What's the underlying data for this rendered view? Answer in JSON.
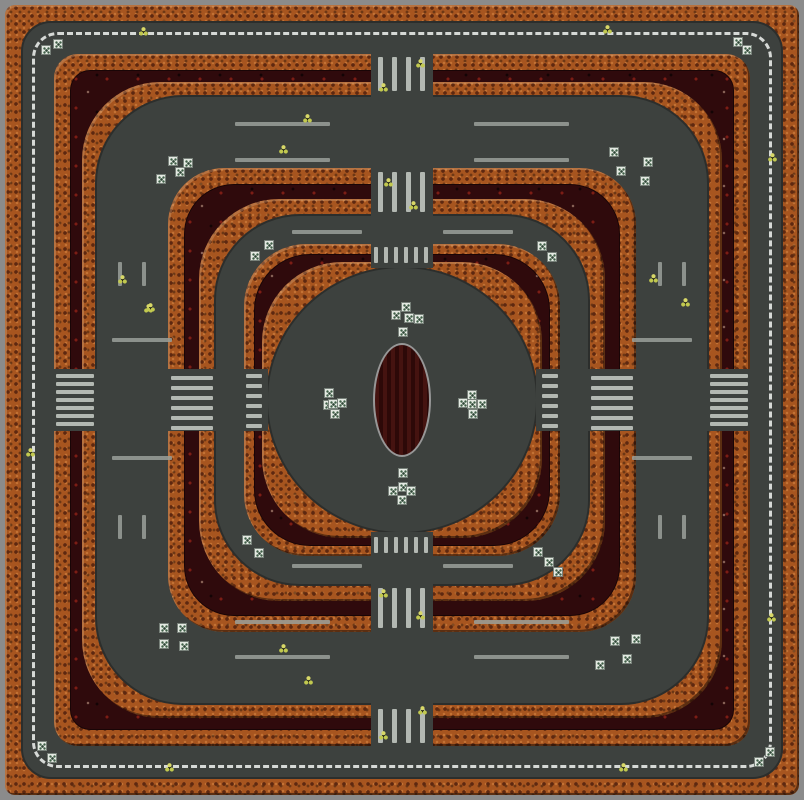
{
  "map": {
    "width": 804,
    "height": 800,
    "colors": {
      "frame": "#8b8b8b",
      "road": "#3d413e",
      "brick": "#a7551f",
      "brickDot": "#5e2810",
      "maroon": "#2f0a0c",
      "maroonDot": "#7c1d15",
      "bar": "#b3b8b2",
      "stripe": "#9aa09a",
      "dash": "#d6d9d6",
      "boxFill": "#e4e9e2",
      "boxDot": "#3e5e46",
      "spark": "#d8d867",
      "spark2": "#c2c94f",
      "ovalFill": "#451310",
      "ovalBorder": "#979797"
    },
    "rings": [
      {
        "name": "outer-frame",
        "inset": 0,
        "radius": 0,
        "fill": "frame"
      },
      {
        "name": "outer-brick-wall",
        "inset": 5,
        "radius": 10,
        "fill": "brick"
      },
      {
        "name": "outer-road",
        "inset": 21,
        "radius": 30,
        "fill": "road"
      },
      {
        "name": "wall-c-outer-brick",
        "inset": 54,
        "radius": 24,
        "fill": "brick"
      },
      {
        "name": "wall-c-moat",
        "inset": 70,
        "radius": 20,
        "fill": "maroon"
      },
      {
        "name": "wall-c-inner-brick",
        "inset": 82,
        "radius": 78,
        "fill": "brick"
      },
      {
        "name": "road-ring-2",
        "inset": 95,
        "radius": 88,
        "fill": "road"
      },
      {
        "name": "wall-b-outer-brick",
        "inset": 168,
        "radius": 56,
        "fill": "brick"
      },
      {
        "name": "wall-b-moat",
        "inset": 184,
        "radius": 50,
        "fill": "maroon"
      },
      {
        "name": "wall-b-inner-brick",
        "inset": 199,
        "radius": 80,
        "fill": "brick"
      },
      {
        "name": "road-ring-3",
        "inset": 214,
        "radius": 86,
        "fill": "road"
      },
      {
        "name": "wall-a-outer-brick",
        "inset": 244,
        "radius": 62,
        "fill": "brick"
      },
      {
        "name": "wall-a-moat",
        "inset": 254,
        "radius": 56,
        "fill": "maroon"
      },
      {
        "name": "wall-a-inner-brick",
        "inset": 262,
        "radius": 80,
        "fill": "brick"
      },
      {
        "name": "center-plaza",
        "inset": 266,
        "radius": "50%",
        "fill": "road"
      }
    ],
    "center_dash_ring": {
      "inset": 32,
      "radius": 26
    },
    "oval": {
      "cx": 402,
      "cy": 400,
      "w": 58,
      "h": 114
    },
    "crossings": [
      {
        "name": "north-outer",
        "cut": [
          371,
          52,
          62,
          45
        ],
        "bars": {
          "o": "v",
          "x": 378,
          "y": 57,
          "step": 14,
          "count": 4,
          "len": 34,
          "th": 5
        }
      },
      {
        "name": "north-mid",
        "cut": [
          371,
          167,
          62,
          49
        ],
        "bars": {
          "o": "v",
          "x": 378,
          "y": 172,
          "step": 14,
          "count": 4,
          "len": 40,
          "th": 5
        }
      },
      {
        "name": "north-inner",
        "cut": [
          371,
          243,
          62,
          25
        ],
        "bars": {
          "o": "v",
          "x": 374,
          "y": 247,
          "step": 10,
          "count": 6,
          "len": 16,
          "th": 4
        }
      },
      {
        "name": "south-inner",
        "cut": [
          371,
          532,
          62,
          25
        ],
        "bars": {
          "o": "v",
          "x": 374,
          "y": 537,
          "step": 10,
          "count": 6,
          "len": 16,
          "th": 4
        }
      },
      {
        "name": "south-mid",
        "cut": [
          371,
          584,
          62,
          49
        ],
        "bars": {
          "o": "v",
          "x": 378,
          "y": 588,
          "step": 14,
          "count": 4,
          "len": 40,
          "th": 5
        }
      },
      {
        "name": "south-outer",
        "cut": [
          371,
          703,
          62,
          45
        ],
        "bars": {
          "o": "v",
          "x": 378,
          "y": 709,
          "step": 14,
          "count": 4,
          "len": 34,
          "th": 5
        }
      },
      {
        "name": "west-outer",
        "cut": [
          52,
          369,
          45,
          62
        ],
        "bars": {
          "o": "h",
          "x": 56,
          "y": 374,
          "step": 8,
          "count": 7,
          "len": 38,
          "th": 4
        }
      },
      {
        "name": "west-mid",
        "cut": [
          167,
          369,
          49,
          62
        ],
        "bars": {
          "o": "h",
          "x": 171,
          "y": 376,
          "step": 10,
          "count": 6,
          "len": 42,
          "th": 4
        }
      },
      {
        "name": "west-inner",
        "cut": [
          243,
          369,
          25,
          62
        ],
        "bars": {
          "o": "h",
          "x": 246,
          "y": 374,
          "step": 10,
          "count": 6,
          "len": 16,
          "th": 4
        }
      },
      {
        "name": "east-inner",
        "cut": [
          536,
          369,
          25,
          62
        ],
        "bars": {
          "o": "h",
          "x": 542,
          "y": 374,
          "step": 10,
          "count": 6,
          "len": 16,
          "th": 4
        }
      },
      {
        "name": "east-mid",
        "cut": [
          588,
          369,
          49,
          62
        ],
        "bars": {
          "o": "h",
          "x": 591,
          "y": 376,
          "step": 10,
          "count": 6,
          "len": 42,
          "th": 4
        }
      },
      {
        "name": "east-outer",
        "cut": [
          707,
          369,
          45,
          62
        ],
        "bars": {
          "o": "h",
          "x": 710,
          "y": 374,
          "step": 8,
          "count": 7,
          "len": 38,
          "th": 4
        }
      }
    ],
    "lane_stripes": [
      [
        292,
        230,
        70,
        4
      ],
      [
        443,
        230,
        70,
        4
      ],
      [
        292,
        564,
        70,
        4
      ],
      [
        443,
        564,
        70,
        4
      ],
      [
        112,
        338,
        60,
        4
      ],
      [
        112,
        456,
        60,
        4
      ],
      [
        632,
        338,
        60,
        4
      ],
      [
        632,
        456,
        60,
        4
      ],
      [
        235,
        620,
        95,
        4
      ],
      [
        474,
        620,
        95,
        4
      ],
      [
        235,
        655,
        95,
        4
      ],
      [
        474,
        655,
        95,
        4
      ],
      [
        235,
        122,
        95,
        4
      ],
      [
        474,
        122,
        95,
        4
      ],
      [
        235,
        158,
        95,
        4
      ],
      [
        474,
        158,
        95,
        4
      ],
      [
        658,
        262,
        4,
        24
      ],
      [
        682,
        262,
        4,
        24
      ],
      [
        658,
        515,
        4,
        24
      ],
      [
        682,
        515,
        4,
        24
      ],
      [
        118,
        262,
        4,
        24
      ],
      [
        142,
        262,
        4,
        24
      ],
      [
        118,
        515,
        4,
        24
      ],
      [
        142,
        515,
        4,
        24
      ]
    ],
    "item_boxes": [
      [
        46,
        50
      ],
      [
        58,
        44
      ],
      [
        738,
        42
      ],
      [
        747,
        50
      ],
      [
        42,
        746
      ],
      [
        52,
        758
      ],
      [
        770,
        752
      ],
      [
        759,
        762
      ],
      [
        161,
        179
      ],
      [
        173,
        161
      ],
      [
        188,
        163
      ],
      [
        180,
        172
      ],
      [
        614,
        152
      ],
      [
        648,
        162
      ],
      [
        621,
        171
      ],
      [
        645,
        181
      ],
      [
        269,
        245
      ],
      [
        255,
        256
      ],
      [
        542,
        246
      ],
      [
        552,
        257
      ],
      [
        247,
        540
      ],
      [
        259,
        553
      ],
      [
        538,
        552
      ],
      [
        549,
        562
      ],
      [
        558,
        572
      ],
      [
        164,
        628
      ],
      [
        182,
        628
      ],
      [
        164,
        644
      ],
      [
        184,
        646
      ],
      [
        615,
        641
      ],
      [
        636,
        639
      ],
      [
        627,
        659
      ],
      [
        600,
        665
      ],
      [
        406,
        307
      ],
      [
        396,
        315
      ],
      [
        409,
        318
      ],
      [
        419,
        319
      ],
      [
        403,
        332
      ],
      [
        329,
        393
      ],
      [
        328,
        405
      ],
      [
        333,
        404
      ],
      [
        342,
        403
      ],
      [
        335,
        414
      ],
      [
        472,
        395
      ],
      [
        463,
        403
      ],
      [
        472,
        404
      ],
      [
        482,
        404
      ],
      [
        473,
        414
      ],
      [
        403,
        473
      ],
      [
        403,
        487
      ],
      [
        393,
        491
      ],
      [
        411,
        491
      ],
      [
        402,
        500
      ]
    ],
    "pickups": [
      [
        143,
        31
      ],
      [
        607,
        29
      ],
      [
        420,
        63
      ],
      [
        383,
        87
      ],
      [
        122,
        279
      ],
      [
        148,
        308
      ],
      [
        307,
        118
      ],
      [
        283,
        149
      ],
      [
        150,
        307
      ],
      [
        388,
        182
      ],
      [
        413,
        205
      ],
      [
        653,
        278
      ],
      [
        685,
        302
      ],
      [
        772,
        157
      ],
      [
        623,
        767
      ],
      [
        771,
        617
      ],
      [
        283,
        648
      ],
      [
        308,
        680
      ],
      [
        169,
        767
      ],
      [
        383,
        593
      ],
      [
        420,
        615
      ],
      [
        383,
        735
      ],
      [
        422,
        710
      ],
      [
        30,
        452
      ]
    ]
  }
}
